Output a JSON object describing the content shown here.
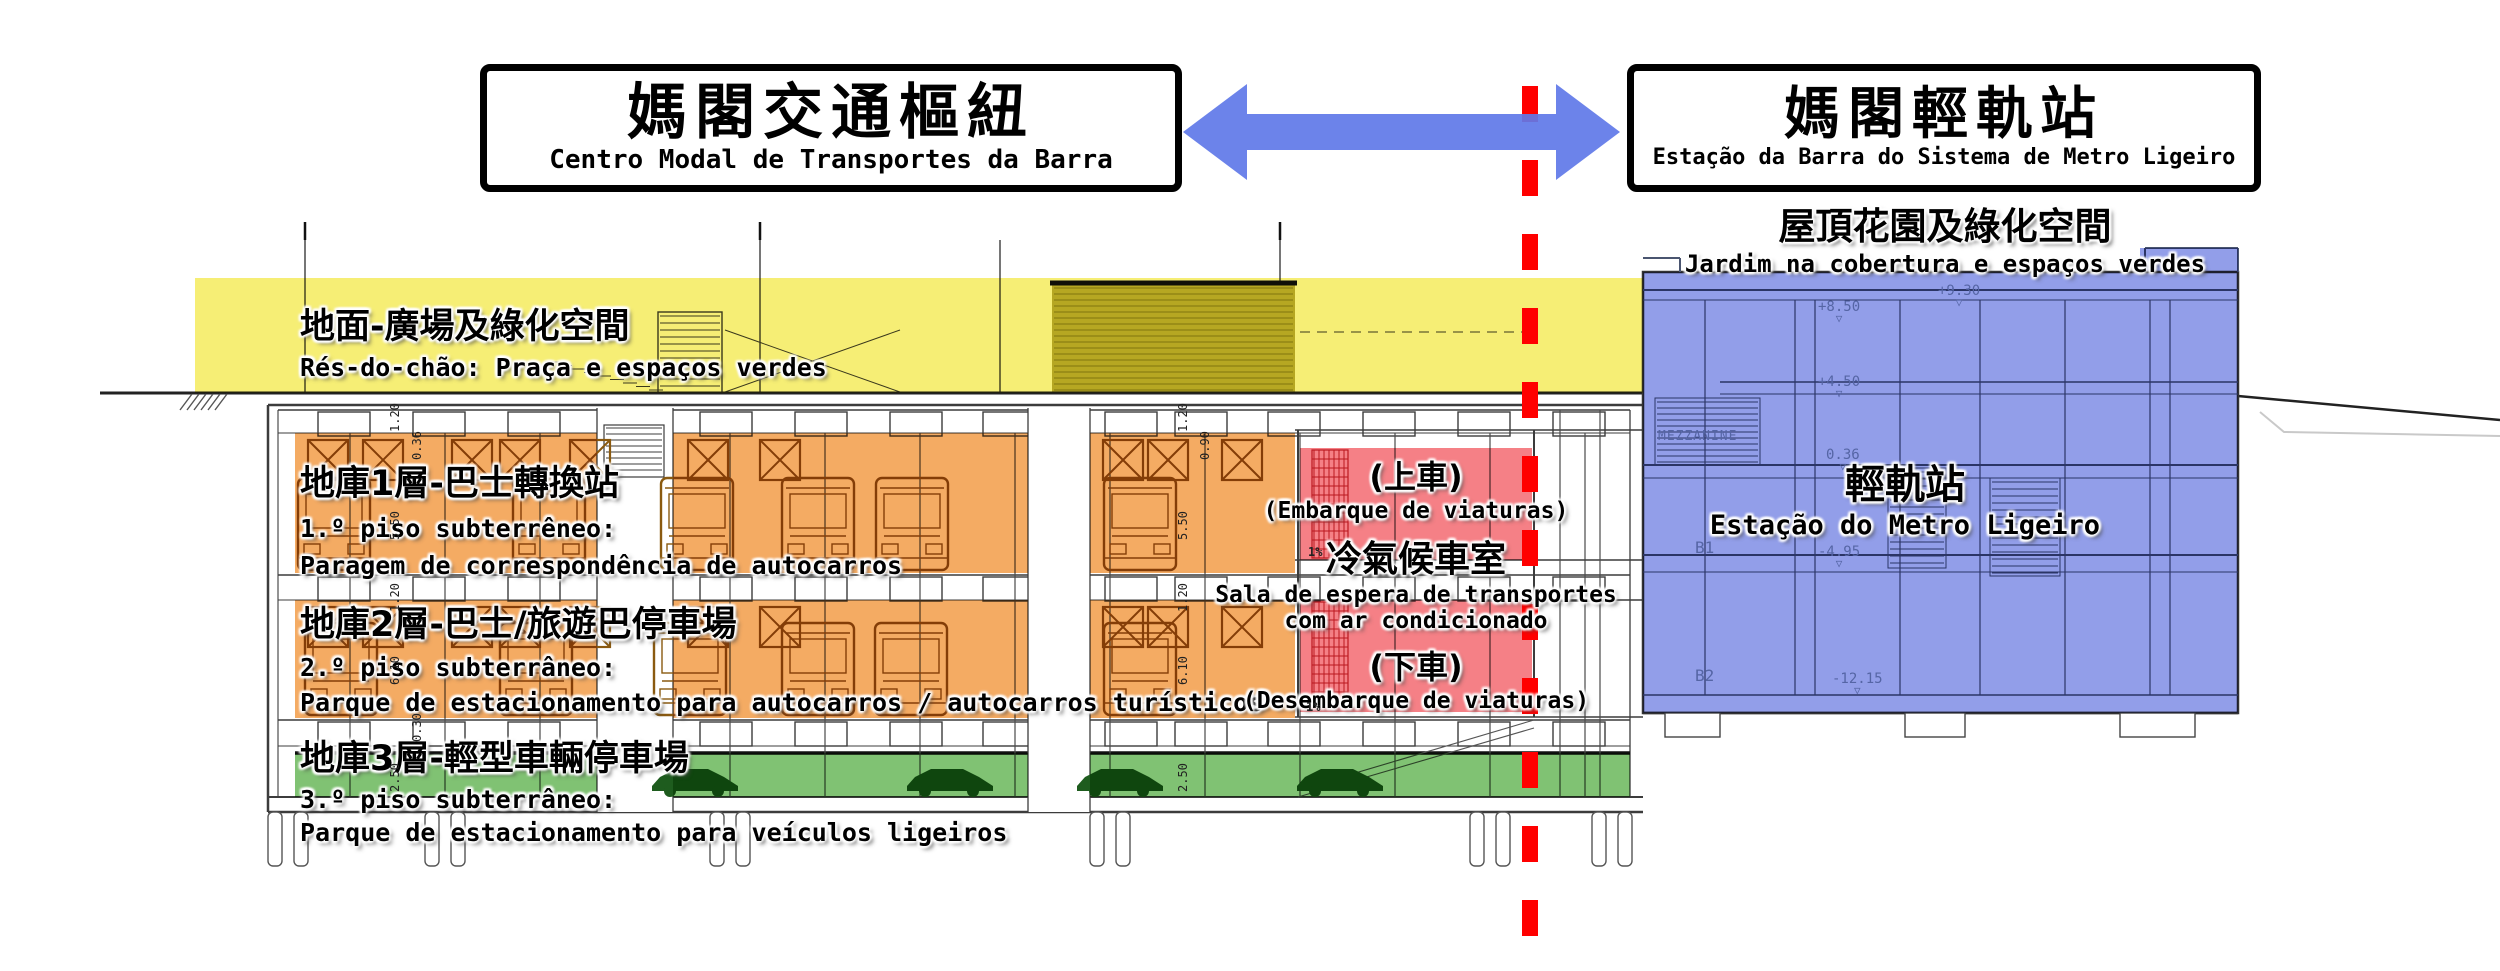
{
  "header": {
    "hub_box": {
      "title_zh": "媽閣交通樞紐",
      "title_pt": "Centro Modal de Transportes da Barra"
    },
    "station_box": {
      "title_zh": "媽閣輕軌站",
      "title_pt": "Estação da Barra do Sistema de Metro Ligeiro"
    }
  },
  "zones": {
    "roof_garden": {
      "zh": "屋頂花園及綠化空間",
      "pt": "Jardim na cobertura e espaços verdes"
    },
    "ground": {
      "zh": "地面-廣場及綠化空間",
      "pt": "Rés-do-chão: Praça e espaços verdes"
    },
    "basement1": {
      "zh": "地庫1層-巴士轉換站",
      "pt_line1": "1.º piso subterrêneo:",
      "pt_line2": "Paragem de correspondência de autocarros"
    },
    "basement2": {
      "zh": "地庫2層-巴士/旅遊巴停車場",
      "pt_line1": "2.º piso subterrâneo:",
      "pt_line2": "Parque de estacionamento para autocarros / autocarros turísticos"
    },
    "basement3": {
      "zh": "地庫3層-輕型車輛停車場",
      "pt_line1": "3.º piso subterrâneo:",
      "pt_line2": "Parque de estacionamento para veículos ligeiros"
    },
    "boarding": {
      "zh": "(上車)",
      "pt": "(Embarque de viaturas)"
    },
    "waiting_room": {
      "zh": "冷氣候車室",
      "pt_line1": "Sala de espera de transportes",
      "pt_line2": "com ar condicionado"
    },
    "alighting": {
      "zh": "(下車)",
      "pt": "(Desembarque de viaturas)"
    },
    "lrt_station": {
      "zh": "輕軌站",
      "pt": "Estação do Metro Ligeiro"
    }
  },
  "cad_labels": {
    "mezzanine": "MEZZANINE",
    "level_b1": "B1",
    "level_b2": "B2",
    "elevations": [
      "+9.30",
      "+8.50",
      "+4.50",
      "0.36",
      "-4.95",
      "-12.15"
    ],
    "dimensions": [
      "1.20",
      "0.36",
      "0.90",
      "5.50",
      "0.30",
      "6.10",
      "2.50"
    ],
    "slope": "1%"
  },
  "icons": {
    "level_marker": "▽"
  },
  "colors": {
    "yellow": "#F6ED6E",
    "olive": "#BDB34A",
    "olive_stripe": "#857C1E",
    "orange": "#F4A75A",
    "green": "#79BF6B",
    "pink": "#F5797F",
    "blue": "#8C99E8",
    "arrow": "#6078E8",
    "red_line": "#FF0000",
    "line": "#3C3C3C",
    "blue_line": "#4A5570",
    "cad_text": "#5565A5",
    "bus": "#8A5A10",
    "car": "#1E5C1E",
    "esc": "#C2303A"
  }
}
